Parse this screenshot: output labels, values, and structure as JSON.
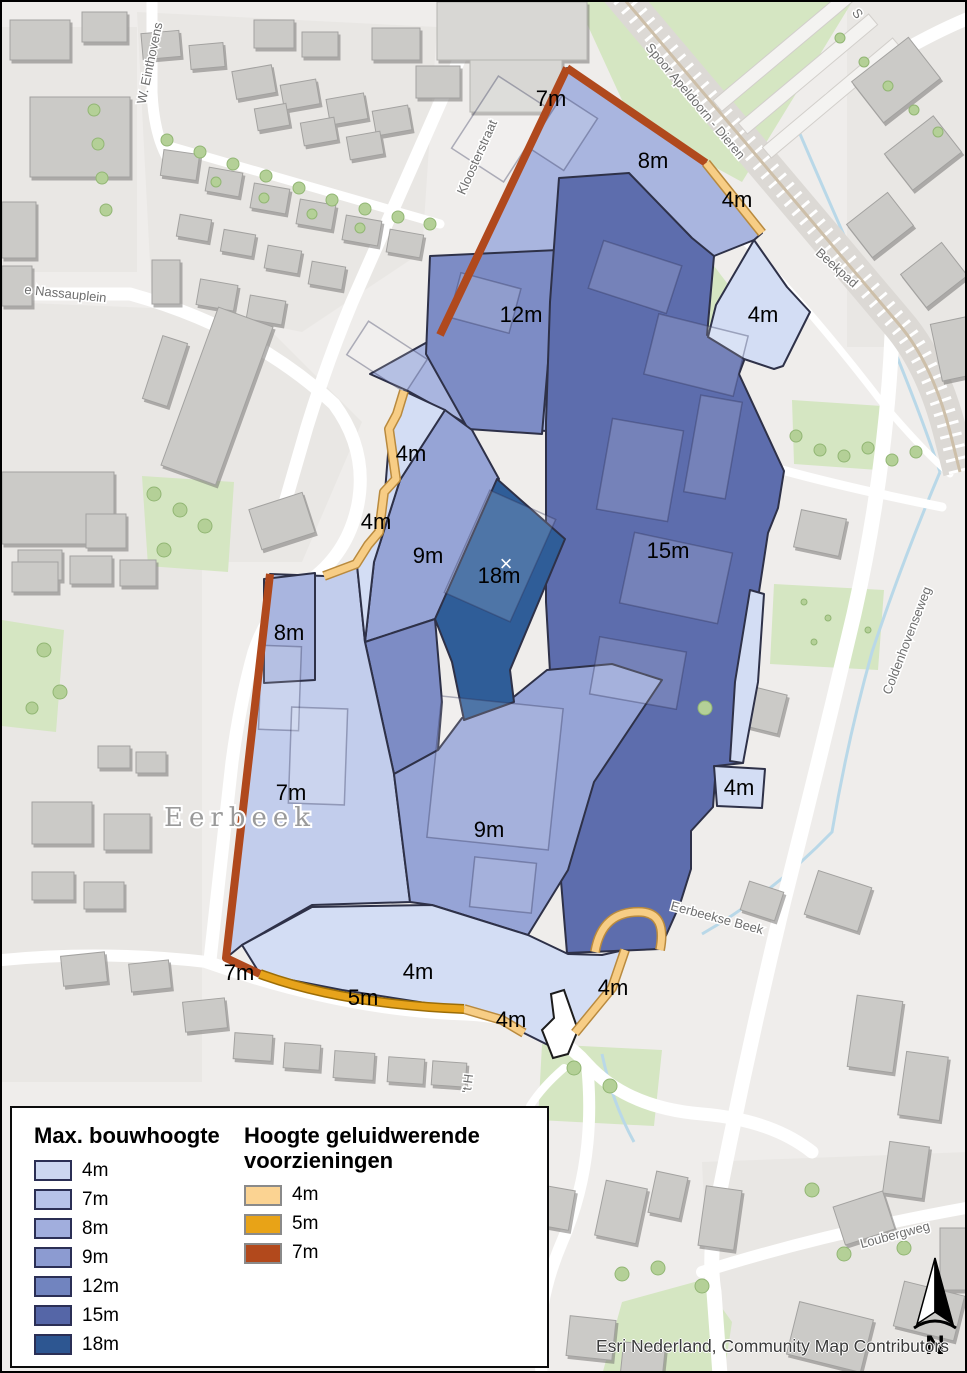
{
  "legend": {
    "building_title": "Max. bouwhoogte",
    "building_items": [
      {
        "label": "4m",
        "color": "#ccd7f1"
      },
      {
        "label": "7m",
        "color": "#b6c2e8"
      },
      {
        "label": "8m",
        "color": "#a1aedd"
      },
      {
        "label": "9m",
        "color": "#8c9bd1"
      },
      {
        "label": "12m",
        "color": "#7184bf"
      },
      {
        "label": "15m",
        "color": "#5566a7"
      },
      {
        "label": "18m",
        "color": "#2d5691"
      }
    ],
    "barrier_title": "Hoogte geluidwerende voorzieningen",
    "barrier_items": [
      {
        "label": "4m",
        "color": "#fbd392"
      },
      {
        "label": "5m",
        "color": "#e8a317"
      },
      {
        "label": "7m",
        "color": "#b2491c"
      }
    ]
  },
  "colors": {
    "zones": {
      "z4": "#d3ddf4",
      "z7": "#c2cdec",
      "z8": "#a9b5df",
      "z9": "#96a4d6",
      "z12": "#7d8cc5",
      "z15": "#5d6dad",
      "z18": "#2f5d98"
    },
    "zone_border": "#2e3148",
    "barriers": {
      "b4": "#f7cd85",
      "b5": "#e7a31b",
      "b7": "#b0491d"
    }
  },
  "map": {
    "height_labels": [
      {
        "text": "7m",
        "x": 549,
        "y": 104
      },
      {
        "text": "8m",
        "x": 651,
        "y": 166
      },
      {
        "text": "4m",
        "x": 735,
        "y": 205
      },
      {
        "text": "12m",
        "x": 519,
        "y": 320
      },
      {
        "text": "4m",
        "x": 761,
        "y": 320
      },
      {
        "text": "4m",
        "x": 409,
        "y": 459
      },
      {
        "text": "4m",
        "x": 374,
        "y": 527
      },
      {
        "text": "9m",
        "x": 426,
        "y": 561
      },
      {
        "text": "18m",
        "x": 497,
        "y": 581
      },
      {
        "text": "15m",
        "x": 666,
        "y": 556
      },
      {
        "text": "8m",
        "x": 287,
        "y": 638
      },
      {
        "text": "7m",
        "x": 289,
        "y": 798
      },
      {
        "text": "9m",
        "x": 487,
        "y": 835
      },
      {
        "text": "4m",
        "x": 737,
        "y": 793
      },
      {
        "text": "7m",
        "x": 237,
        "y": 978
      },
      {
        "text": "5m",
        "x": 361,
        "y": 1003
      },
      {
        "text": "4m",
        "x": 416,
        "y": 977
      },
      {
        "text": "4m",
        "x": 509,
        "y": 1025
      },
      {
        "text": "4m",
        "x": 611,
        "y": 993
      }
    ],
    "street_labels": [
      {
        "text": "W. Einthovens",
        "x": 152,
        "y": 62,
        "rot": -78
      },
      {
        "text": "Kloosterstraat",
        "x": 479,
        "y": 157,
        "rot": -66
      },
      {
        "text": "Spoor Apeldoorn - Dieren",
        "x": 690,
        "y": 102,
        "rot": 50
      },
      {
        "text": "Beekpad",
        "x": 832,
        "y": 269,
        "rot": 42
      },
      {
        "text": "e Nassauplein",
        "x": 63,
        "y": 296,
        "rot": 6
      },
      {
        "text": "Eerbeekse Beek",
        "x": 714,
        "y": 920,
        "rot": 15
      },
      {
        "text": "Coldenhovenseweg",
        "x": 909,
        "y": 640,
        "rot": -69
      },
      {
        "text": "Loubergweg",
        "x": 894,
        "y": 1237,
        "rot": -15
      },
      {
        "text": "'t H",
        "x": 470,
        "y": 1082,
        "rot": -83
      },
      {
        "text": "S",
        "x": 852,
        "y": 14,
        "rot": 55
      }
    ],
    "place_label": "Eerbeek",
    "marker": "×"
  },
  "attribution": "Esri Nederland, Community Map Contributors",
  "north_label": "N"
}
